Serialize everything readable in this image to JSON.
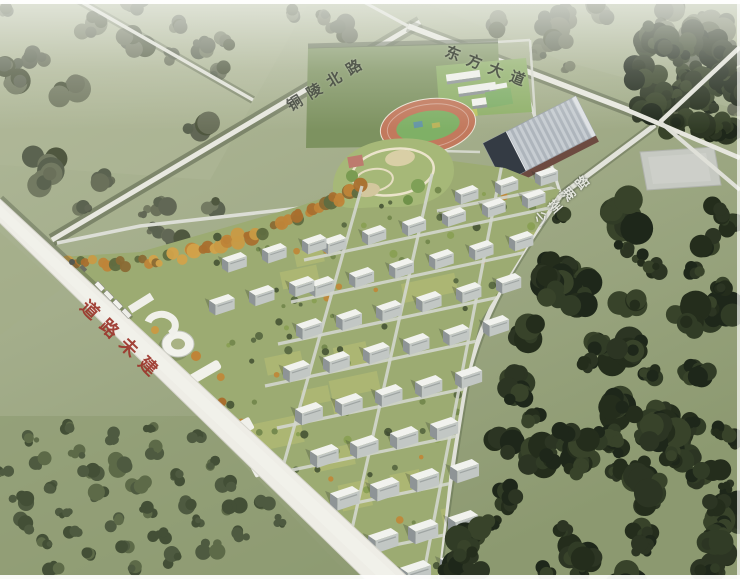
{
  "image": {
    "type": "aerial-masterplan-rendering",
    "view": "bird's-eye perspective of planned residential district with school, park and factory"
  },
  "labels": {
    "road_tongling": {
      "text": "铜陵北路"
    },
    "road_avenue": {
      "text": "东方大道"
    },
    "road_lake": {
      "text": "少荃湖路"
    },
    "road_unbuilt": {
      "text": "道路未建"
    }
  },
  "colors": {
    "field_pale": "#a9b293",
    "grass_olive": "#7f8c60",
    "forest_dark": "#2b3422",
    "road_white": "#e8e8e0",
    "unbuilt_road": "#eeede6",
    "label_red": "#9c352b",
    "label_dark": "#474b44",
    "track_ring": "#c2795d",
    "track_infield": "#7fb066",
    "factory_roof": "#bfc5cb",
    "factory_dark": "#343b44",
    "ribbon_orange": "#c6913f"
  }
}
